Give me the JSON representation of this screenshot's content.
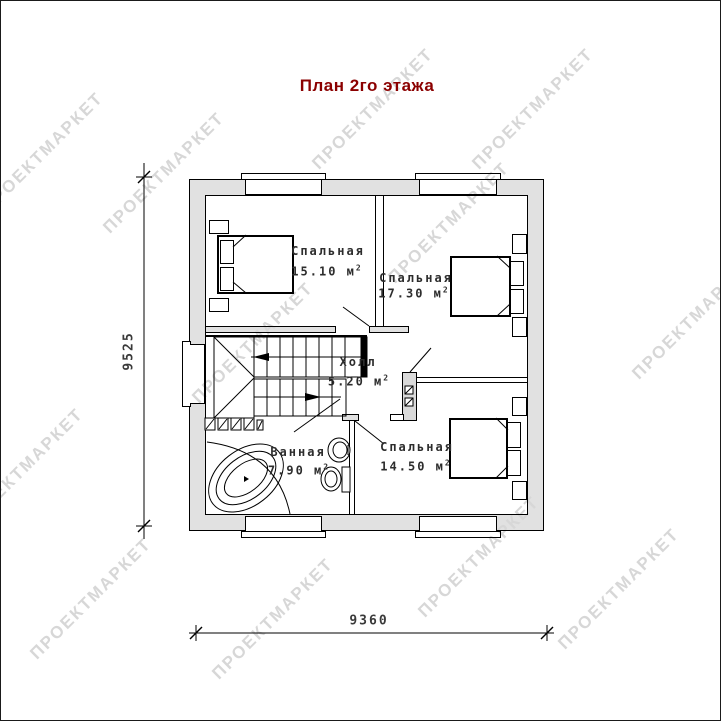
{
  "title": "План 2го этажа",
  "watermark": {
    "text": "ПРОЕКТМАРКЕТ"
  },
  "rooms": {
    "bedroom1": {
      "name": "Спальная",
      "area": "15.10 м",
      "sup": "2"
    },
    "bedroom2": {
      "name": "Спальная",
      "area": "17.30 м",
      "sup": "2"
    },
    "hall": {
      "name": "Холл",
      "area": "5.20 м",
      "sup": "2"
    },
    "bathroom": {
      "name": "Ванная",
      "area": "7.90 м",
      "sup": "2"
    },
    "bedroom3": {
      "name": "Спальная",
      "area": "14.50 м",
      "sup": "2"
    }
  },
  "dimensions": {
    "vertical": "9525",
    "horizontal": "9360"
  }
}
